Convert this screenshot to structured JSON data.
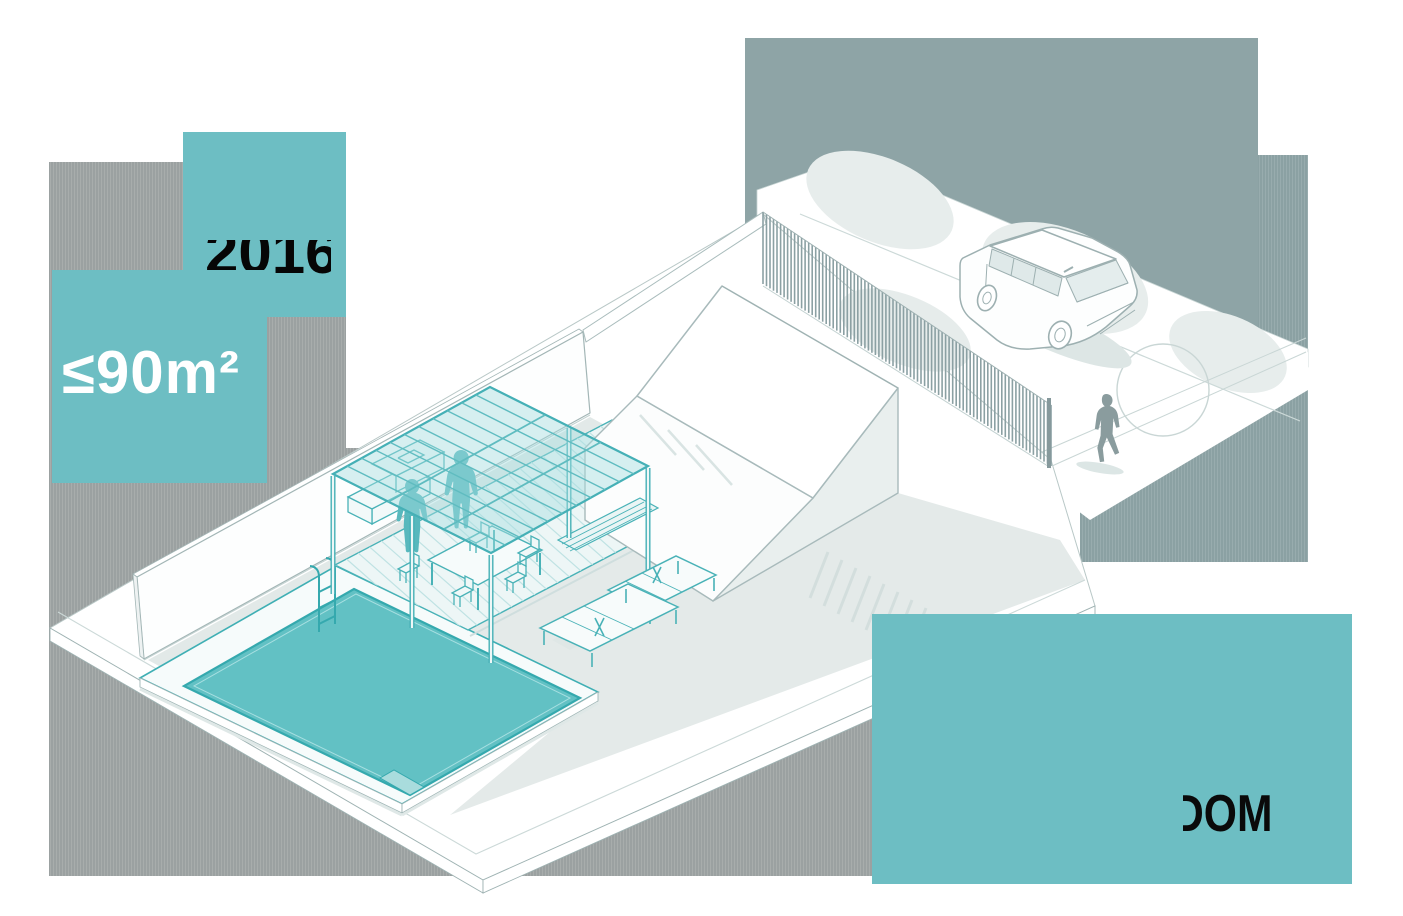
{
  "badges": {
    "year_badge": {
      "text": "2016",
      "bg": "#6dbec3",
      "text_color": "#060606"
    },
    "area_badge": {
      "text": "≤90m²",
      "bg": "#6dbec3",
      "text_color": "#ffffff"
    },
    "dom_badge": {
      "text": "DOM",
      "bg": "#6dbec3",
      "text_color": "#0a0a0a"
    }
  },
  "palette": {
    "teal_accent": "#6dbec3",
    "pool_water": "#62c1c4",
    "teal_line": "#45b0b6",
    "slate_block": "#8ea4a6",
    "gray_block": "#9ba1a1",
    "outline": "#a8babb",
    "shadow": "#e2e9e8",
    "silhouette_gray": "#8a9c9e",
    "silhouette_teal": "#58b8bd"
  },
  "scene": {
    "elements": [
      "lot",
      "perimeter-wall",
      "house",
      "swimming-pool",
      "pool-ladder",
      "wood-deck",
      "pergola",
      "dining-table",
      "chairs",
      "bench",
      "outdoor-counter",
      "sun-loungers",
      "fence",
      "gate-post",
      "street",
      "sidewalk",
      "car",
      "pedestrian",
      "people-under-pergola",
      "tree-shadows"
    ],
    "fence": {
      "slat_count": 82
    },
    "deck": {
      "board_count": 24
    },
    "canopy": {
      "slat_count": 10
    },
    "shadow_stripes": {
      "count": 12
    }
  }
}
